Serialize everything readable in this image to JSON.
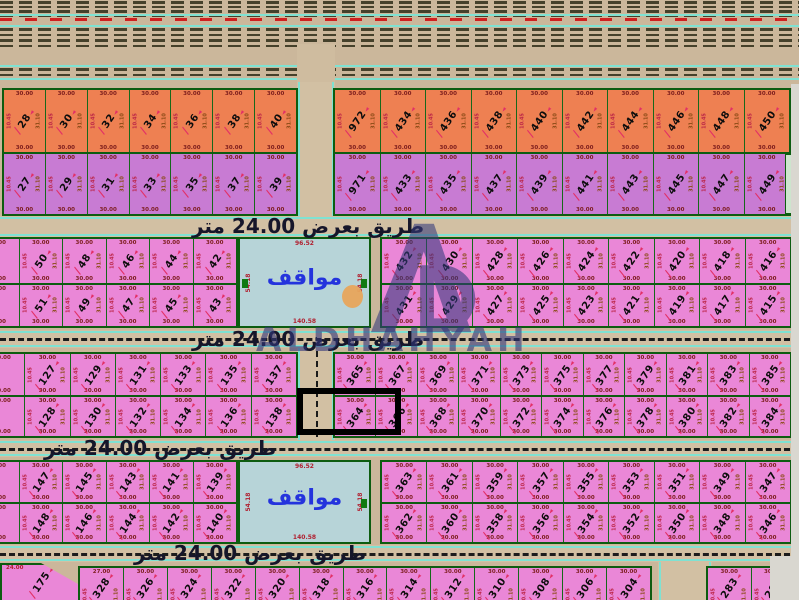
{
  "labels": {
    "road": "طريق بعرض 24.00 متر",
    "parking": "مواقف",
    "watermark": "ALDHAHYAH"
  },
  "dims": {
    "w": "30.00",
    "s1": "10.45",
    "s2": "31.10",
    "p_top": "96.52",
    "p_bottom": "140.58",
    "p_side": "54.18",
    "corner": "24.00",
    "first": "27.00"
  },
  "colors": {
    "orange_plot": "#ee8052",
    "purple_plot": "#c87bd3",
    "pink_plot": "#ea87d7",
    "parking_fill": "#b7d4d8",
    "plot_border": "#0d5c10",
    "road_line_teal": "#7fe2d2",
    "highlight": "#000000",
    "watermark": "#31367a",
    "red_dim": "#e23066"
  },
  "plots": {
    "b1_left_top": [
      "28",
      "30",
      "32",
      "34",
      "36",
      "38",
      "40"
    ],
    "b1_left_bottom": [
      "27",
      "29",
      "31",
      "33",
      "35",
      "37",
      "39"
    ],
    "b1_right_top": [
      "972",
      "434",
      "436",
      "438",
      "440",
      "442",
      "444",
      "446",
      "448",
      "450"
    ],
    "b1_right_bottom": [
      "971",
      "433",
      "435",
      "437",
      "439",
      "441",
      "443",
      "445",
      "447",
      "449"
    ],
    "b2_left_top": [
      "50",
      "48",
      "46",
      "44",
      "42"
    ],
    "b2_left_bottom": [
      "51",
      "49",
      "47",
      "45",
      "43"
    ],
    "b2_right_top": [
      "432",
      "430",
      "428",
      "426",
      "424",
      "422",
      "420",
      "418",
      "416"
    ],
    "b2_right_bottom": [
      "431",
      "429",
      "427",
      "425",
      "423",
      "421",
      "419",
      "417",
      "415"
    ],
    "b3_left_top": [
      "127",
      "129",
      "131",
      "133",
      "135",
      "137"
    ],
    "b3_left_bottom": [
      "128",
      "130",
      "132",
      "134",
      "136",
      "138"
    ],
    "b3_right_top": [
      "365",
      "367",
      "369",
      "371",
      "373",
      "375",
      "377",
      "379",
      "381",
      "383",
      "385"
    ],
    "b3_right_bottom": [
      "364",
      "366",
      "368",
      "370",
      "372",
      "374",
      "376",
      "378",
      "380",
      "382",
      "384"
    ],
    "b4_left_top": [
      "147",
      "145",
      "143",
      "141",
      "139"
    ],
    "b4_left_bottom": [
      "148",
      "146",
      "144",
      "142",
      "140"
    ],
    "b4_right_top": [
      "363",
      "361",
      "359",
      "357",
      "355",
      "353",
      "351",
      "349",
      "347"
    ],
    "b4_right_bottom": [
      "362",
      "360",
      "358",
      "356",
      "354",
      "352",
      "350",
      "348",
      "346"
    ],
    "b5_mid": [
      "328",
      "326",
      "324",
      "322",
      "320",
      "318",
      "316",
      "314",
      "312",
      "310",
      "308",
      "306",
      "304"
    ],
    "b5_right": [
      "283",
      "281"
    ],
    "b5_corner": "175"
  },
  "highlight_plots": [
    "364",
    "366"
  ]
}
